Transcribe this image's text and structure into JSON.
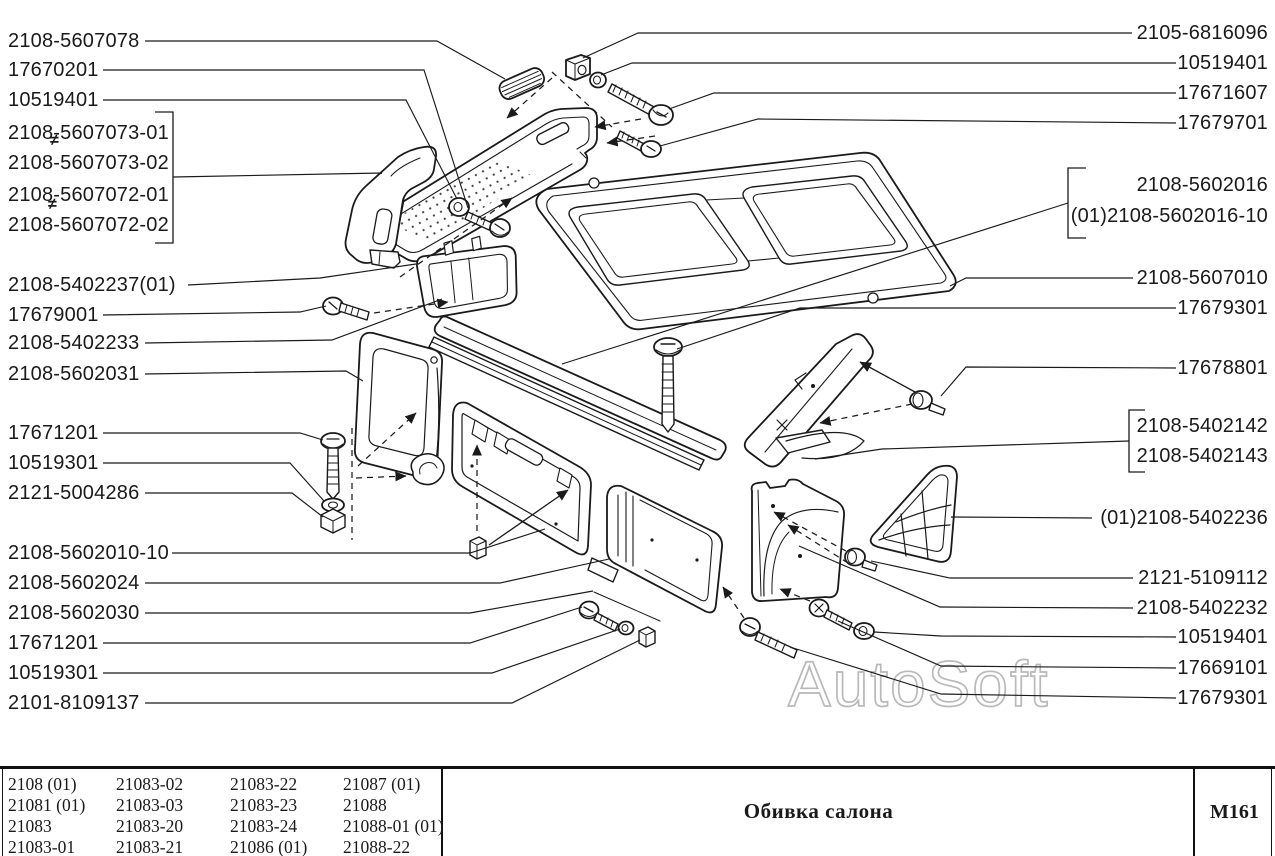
{
  "watermark": {
    "text": "AutoSoft"
  },
  "labels": {
    "not_interchangeable_mark": "≠",
    "left": [
      "2108-5607078",
      "17670201",
      "10519401",
      "2108-5607073-01",
      "2108-5607073-02",
      "2108-5607072-01",
      "2108-5607072-02",
      "2108-5402237(01)",
      "17679001",
      "2108-5402233",
      "2108-5602031",
      "17671201",
      "10519301",
      "2121-5004286",
      "2108-5602010-10",
      "2108-5602024",
      "2108-5602030",
      "17671201",
      "10519301",
      "2101-8109137"
    ],
    "right": [
      "2105-6816096",
      "10519401",
      "17671607",
      "17679701",
      "2108-5602016",
      "(01)2108-5602016-10",
      "2108-5607010",
      "17679301",
      "17678801",
      "2108-5402142",
      "2108-5402143",
      "(01)2108-5402236",
      "2121-5109112",
      "2108-5402232",
      "10519401",
      "17669101",
      "17679301"
    ]
  },
  "footer": {
    "title": "Обивка салона",
    "code": "M161",
    "model_columns": [
      [
        "2108 (01)",
        "21081 (01)",
        "21083",
        "21083-01"
      ],
      [
        "21083-02",
        "21083-03",
        "21083-20",
        "21083-21"
      ],
      [
        "21083-22",
        "21083-23",
        "21083-24",
        "21086 (01)"
      ],
      [
        "21087 (01)",
        "21088",
        "21088-01 (01)",
        "21088-22"
      ]
    ]
  }
}
